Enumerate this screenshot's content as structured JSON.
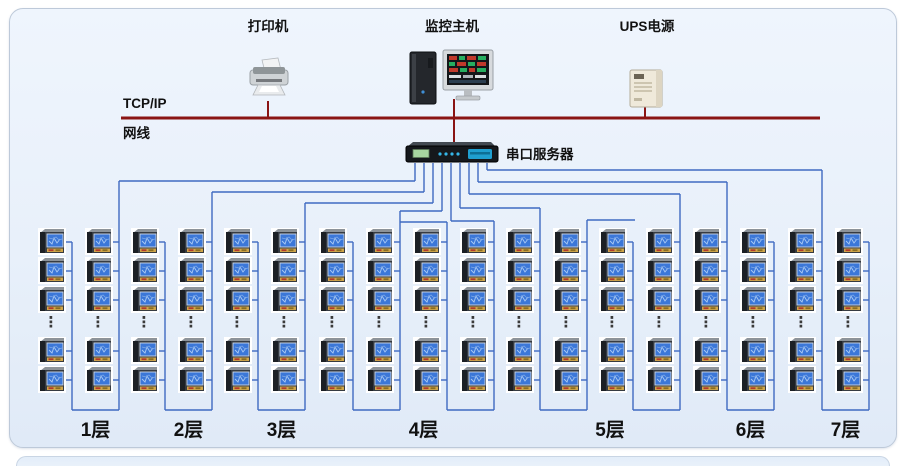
{
  "network": {
    "protocol_label": "TCP/IP",
    "cable_label": "网线"
  },
  "devices": {
    "printer": {
      "label": "打印机"
    },
    "monitor_host": {
      "label": "监控主机"
    },
    "ups": {
      "label": "UPS电源"
    },
    "serial_server": {
      "label": "串口服务器"
    }
  },
  "floors": [
    {
      "label": "1层",
      "meter_columns": 2
    },
    {
      "label": "2层",
      "meter_columns": 2
    },
    {
      "label": "3层",
      "meter_columns": 2
    },
    {
      "label": "4层",
      "meter_columns": 4
    },
    {
      "label": "5层",
      "meter_columns": 4
    },
    {
      "label": "6层",
      "meter_columns": 2
    },
    {
      "label": "7层",
      "meter_columns": 2
    }
  ],
  "meter_grid": {
    "rows_visible_per_column": 5,
    "ellipsis_glyph": "⋮",
    "total_meter_icons": 90
  },
  "colors": {
    "bus": "#8a1414",
    "wire": "#3f6ac1",
    "card_background": "#e8f0fa",
    "meter_screen": "#3b77d8",
    "server_accent": "#1f9fd0"
  }
}
